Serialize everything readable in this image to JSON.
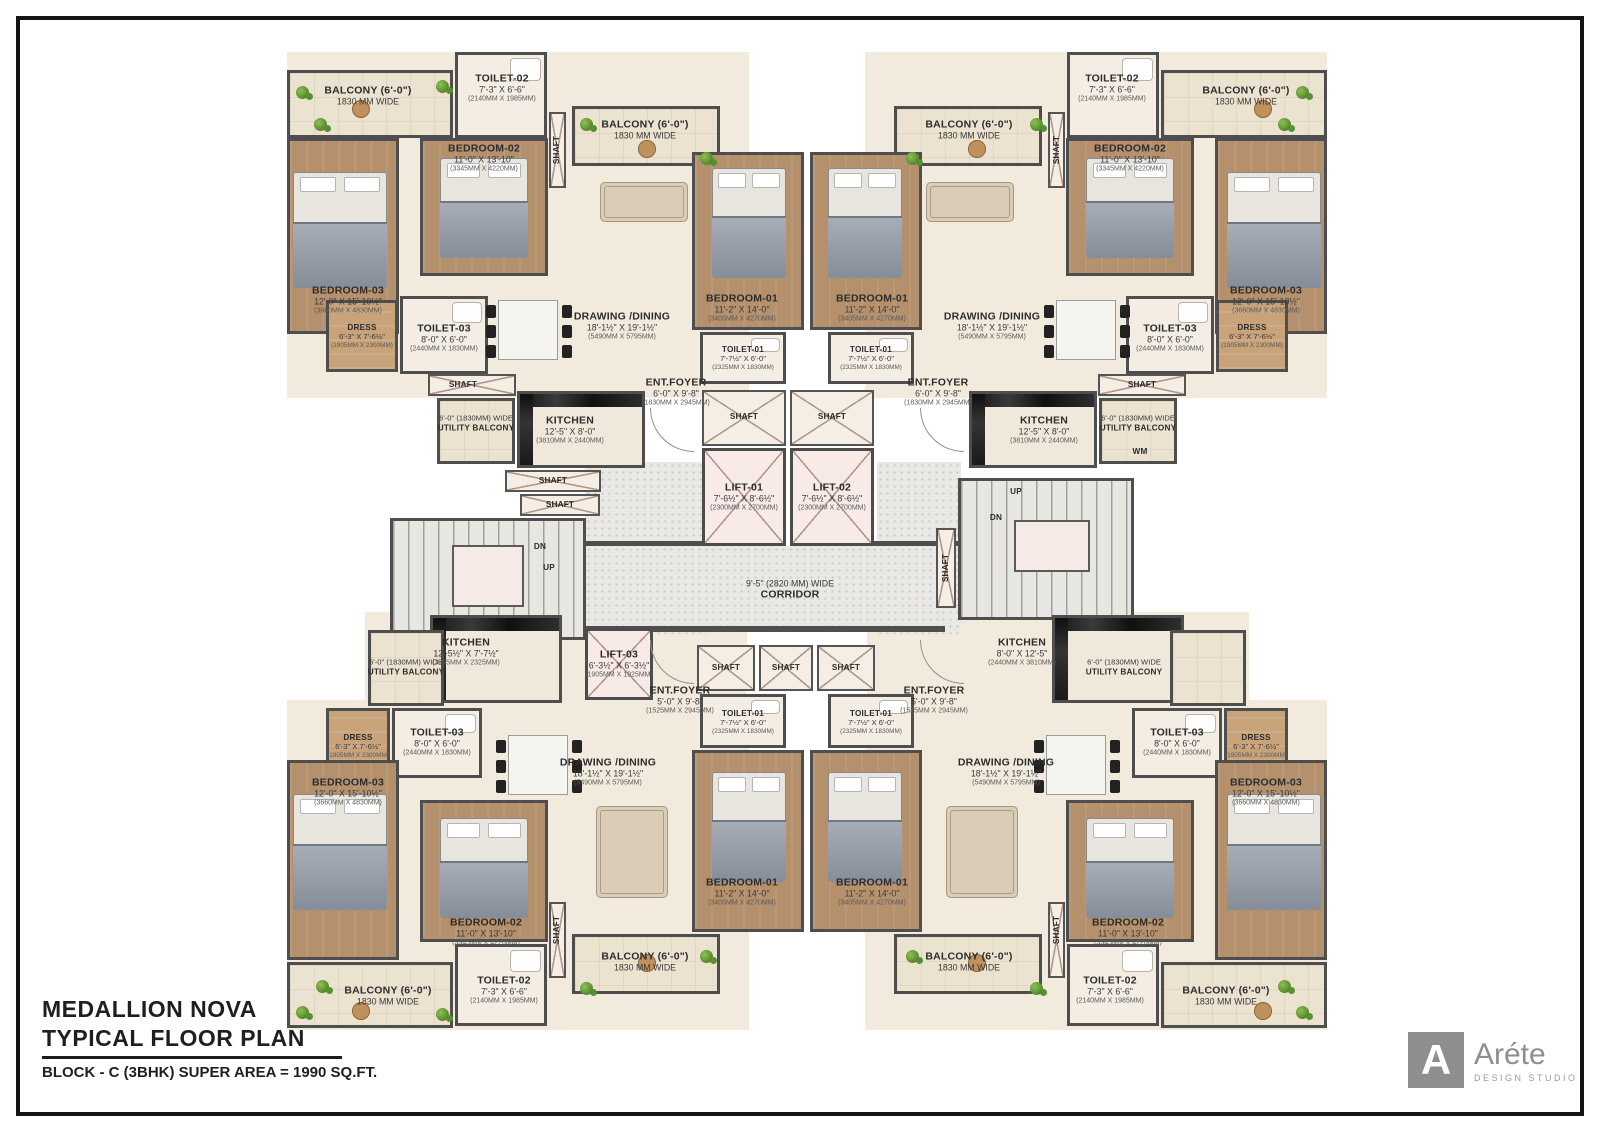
{
  "title_block": {
    "project": "MEDALLION NOVA",
    "subtitle": "TYPICAL FLOOR PLAN",
    "block_info": "BLOCK - C (3BHK) SUPER AREA = 1990 SQ.FT."
  },
  "logo": {
    "monogram": "A",
    "name": "Aréte",
    "tagline": "DESIGN STUDIO"
  },
  "room_types": {
    "bedroom01": {
      "name": "BEDROOM-01",
      "dims": "11'-2\" X 14'-0\"",
      "mm": "(3405MM X 4270MM)"
    },
    "bedroom02": {
      "name": "BEDROOM-02",
      "dims": "11'-0\" X 13'-10\"",
      "mm": "(3345MM X 4220MM)"
    },
    "bedroom03": {
      "name": "BEDROOM-03",
      "dims": "12'-0\" X 15'-10½\"",
      "mm": "(3660MM X 4830MM)"
    },
    "drawing_dining": {
      "name": "DRAWING /DINING",
      "dims": "18'-1½\" X 19'-1½\"",
      "mm": "(5490MM X 5795MM)"
    },
    "kitchen_a": {
      "name": "KITCHEN",
      "dims": "12'-5\" X 8'-0\"",
      "mm": "(3810MM X 2440MM)"
    },
    "kitchen_b": {
      "name": "KITCHEN",
      "dims": "12'-5½\" X 7'-7½\"",
      "mm": "(3795MM X 2325MM)"
    },
    "kitchen_c": {
      "name": "KITCHEN",
      "dims": "8'-0\" X 12'-5\"",
      "mm": "(2440MM X 3810MM)"
    },
    "toilet01": {
      "name": "TOILET-01",
      "dims": "7'-7½\" X 6'-0\"",
      "mm": "(2325MM X 1830MM)"
    },
    "toilet02": {
      "name": "TOILET-02",
      "dims": "7'-3\" X 6'-6\"",
      "mm": "(2140MM X 1985MM)"
    },
    "toilet03": {
      "name": "TOILET-03",
      "dims": "8'-0\" X 6'-0\"",
      "mm": "(2440MM X 1830MM)"
    },
    "dress": {
      "name": "DRESS",
      "dims": "6'-3\" X 7'-6½\"",
      "mm": "(1905MM X 2300MM)"
    },
    "ent_foyer_a": {
      "name": "ENT.FOYER",
      "dims": "6'-0\" X 9'-8\"",
      "mm": "(1830MM X 2945MM)"
    },
    "ent_foyer_b": {
      "name": "ENT.FOYER",
      "dims": "5'-0\" X 9'-8\"",
      "mm": "(1525MM X 2945MM)"
    },
    "balcony": {
      "name": "BALCONY (6'-0\")",
      "dims": "1830 MM WIDE"
    },
    "utility": {
      "pre": "6'-0\" (1830MM) WIDE",
      "name": "UTILITY BALCONY"
    },
    "lift01": {
      "name": "LIFT-01",
      "dims": "7'-6½\" X 8'-6½\"",
      "mm": "(2300MM X 2700MM)"
    },
    "lift02": {
      "name": "LIFT-02",
      "dims": "7'-6½\" X 8'-6½\"",
      "mm": "(2300MM X 2700MM)"
    },
    "lift03": {
      "name": "LIFT-03",
      "dims": "6'-3½\" X 6'-3½\"",
      "mm": "(1905MM X 1925MM)"
    },
    "corridor": {
      "pre": "9'-5\" (2820 MM) WIDE",
      "name": "CORRIDOR"
    },
    "shaft": {
      "name": "SHAFT"
    },
    "up": {
      "name": "UP"
    },
    "dn": {
      "name": "DN"
    },
    "wm": {
      "name": "WM"
    }
  }
}
